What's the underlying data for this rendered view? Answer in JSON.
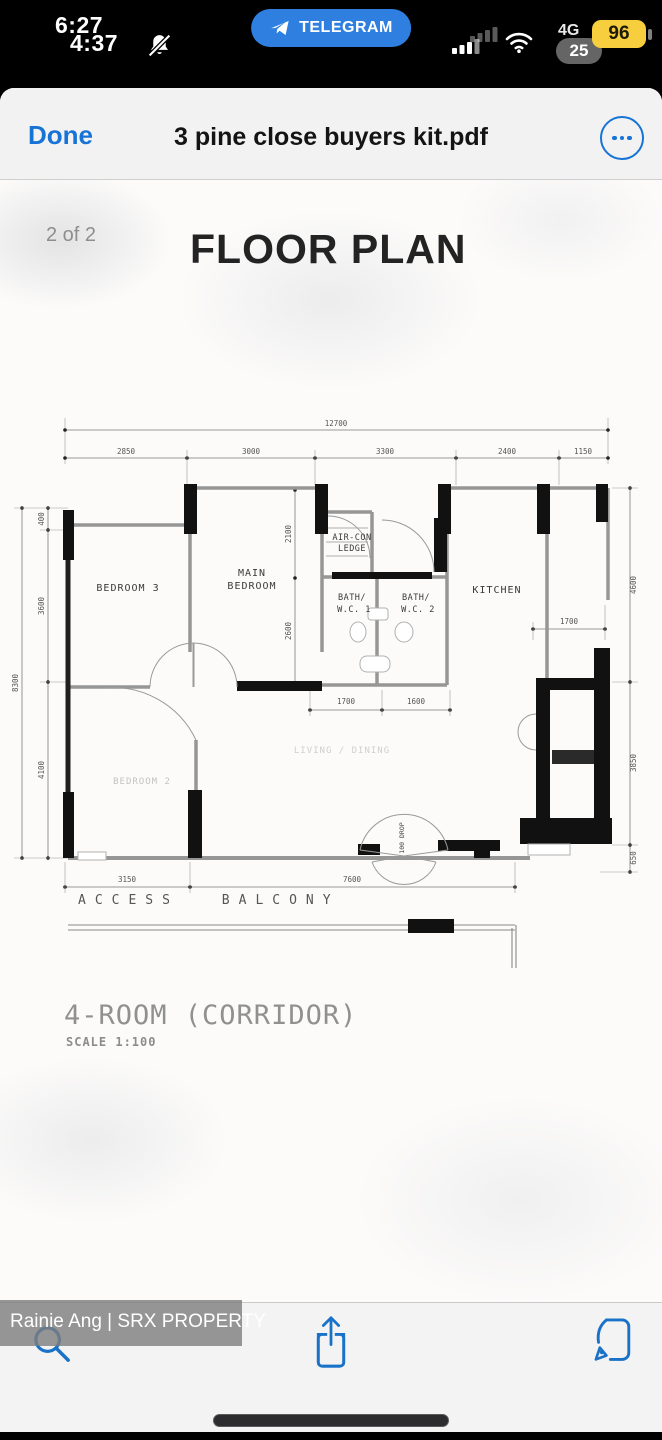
{
  "status_bar": {
    "time_primary": "6:27",
    "time_secondary": "4:37",
    "telegram_label": "TELEGRAM",
    "network": "4G",
    "battery_percent": "96",
    "battery_percent_secondary": "25"
  },
  "header": {
    "done_label": "Done",
    "title": "3 pine close buyers kit.pdf"
  },
  "page": {
    "page_indicator": "2 of 2",
    "doc_title": "FLOOR PLAN",
    "plan_name": "4-ROOM (CORRIDOR)",
    "plan_scale": "SCALE 1:100"
  },
  "floor_plan": {
    "rooms": {
      "bedroom3": "BEDROOM 3",
      "main_bedroom_l1": "MAIN",
      "main_bedroom_l2": "BEDROOM",
      "aircon_l1": "AIR-CON",
      "aircon_l2": "LEDGE",
      "bath1_l1": "BATH/",
      "bath1_l2": "W.C. 1",
      "bath2_l1": "BATH/",
      "bath2_l2": "W.C. 2",
      "kitchen": "KITCHEN",
      "bedroom2": "BEDROOM 2",
      "living_dining": "LIVING / DINING"
    },
    "labels": {
      "access_balcony": "ACCESS BALCONY",
      "entrance_note": "100 DROP"
    },
    "dims": {
      "total_width": "12700",
      "top": [
        "2850",
        "3000",
        "3300",
        "2400",
        "1150"
      ],
      "left_total": "8300",
      "left": [
        "400",
        "3600",
        "4100"
      ],
      "right": [
        "4600",
        "3850",
        "650"
      ],
      "main_bedroom": [
        "2100",
        "2600"
      ],
      "bath_bottom": [
        "1700",
        "1600"
      ],
      "kitchen": "1700",
      "bottom": [
        "3150",
        "7600"
      ]
    }
  },
  "watermark": "Rainie Ang | SRX PROPERTY",
  "toolbar": {
    "icons": [
      "search-icon",
      "share-icon",
      "markup-icon"
    ]
  },
  "colors": {
    "accent_blue": "#1774d6",
    "telegram_blue": "#2e7fe0",
    "battery_yellow": "#f6ce3e"
  }
}
